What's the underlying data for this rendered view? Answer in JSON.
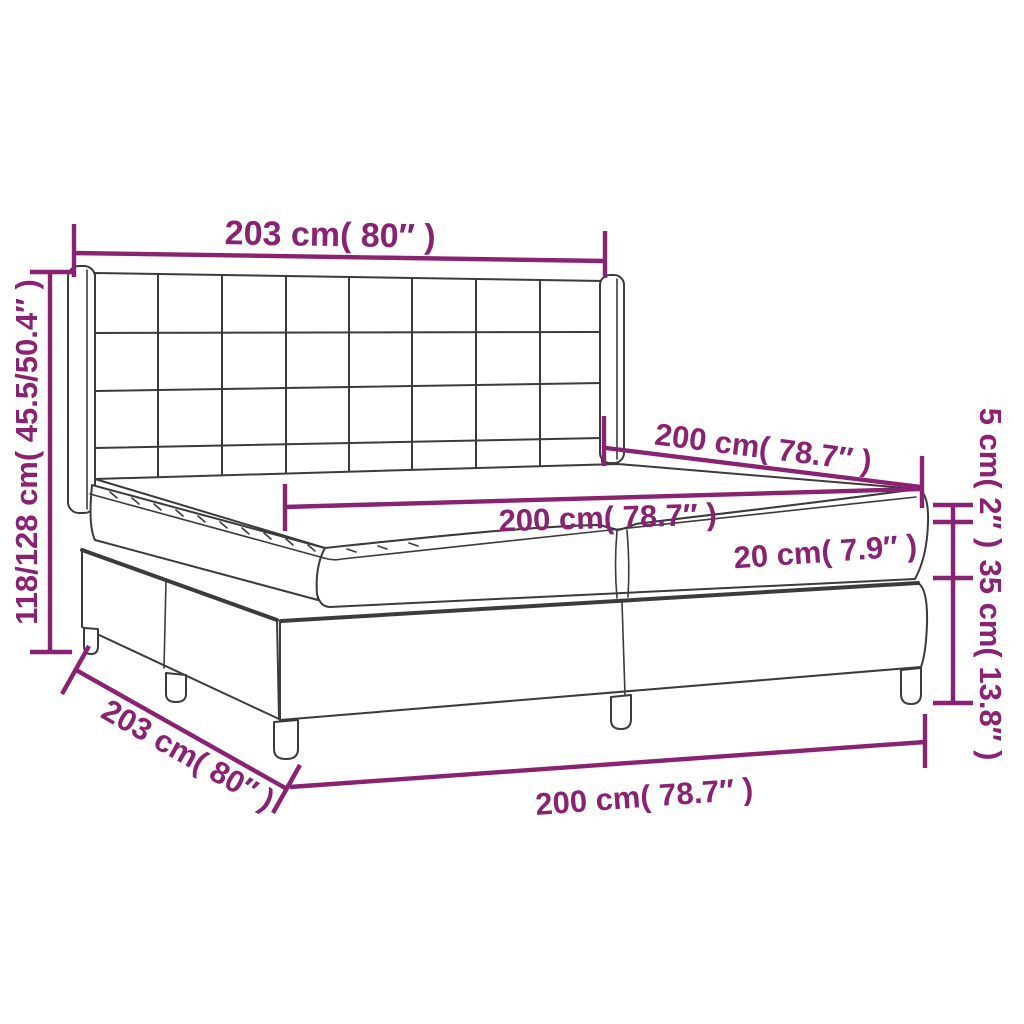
{
  "diagram": {
    "name": "bed-dimension-diagram",
    "subject": "box spring bed with winged square-tufted headboard, split mattress and two-piece base on legs",
    "colors": {
      "dimension": "#8b2170",
      "line_art": "#3d3a3c",
      "background": "#ffffff"
    },
    "dimensions": {
      "headboard_width": "203 cm( 80″ )",
      "overall_height": "118/128 cm( 45.5/50.4″ )",
      "bed_depth_top": "200 cm( 78.7″ )",
      "mattress_width": "200 cm( 78.7″ )",
      "mattress_height": "20 cm( 7.9″ )",
      "topper_height": "5 cm( 2″ )",
      "base_height": "35 cm( 13.8″ )",
      "base_depth": "203 cm( 80″ )",
      "base_width": "200 cm( 78.7″ )"
    }
  }
}
